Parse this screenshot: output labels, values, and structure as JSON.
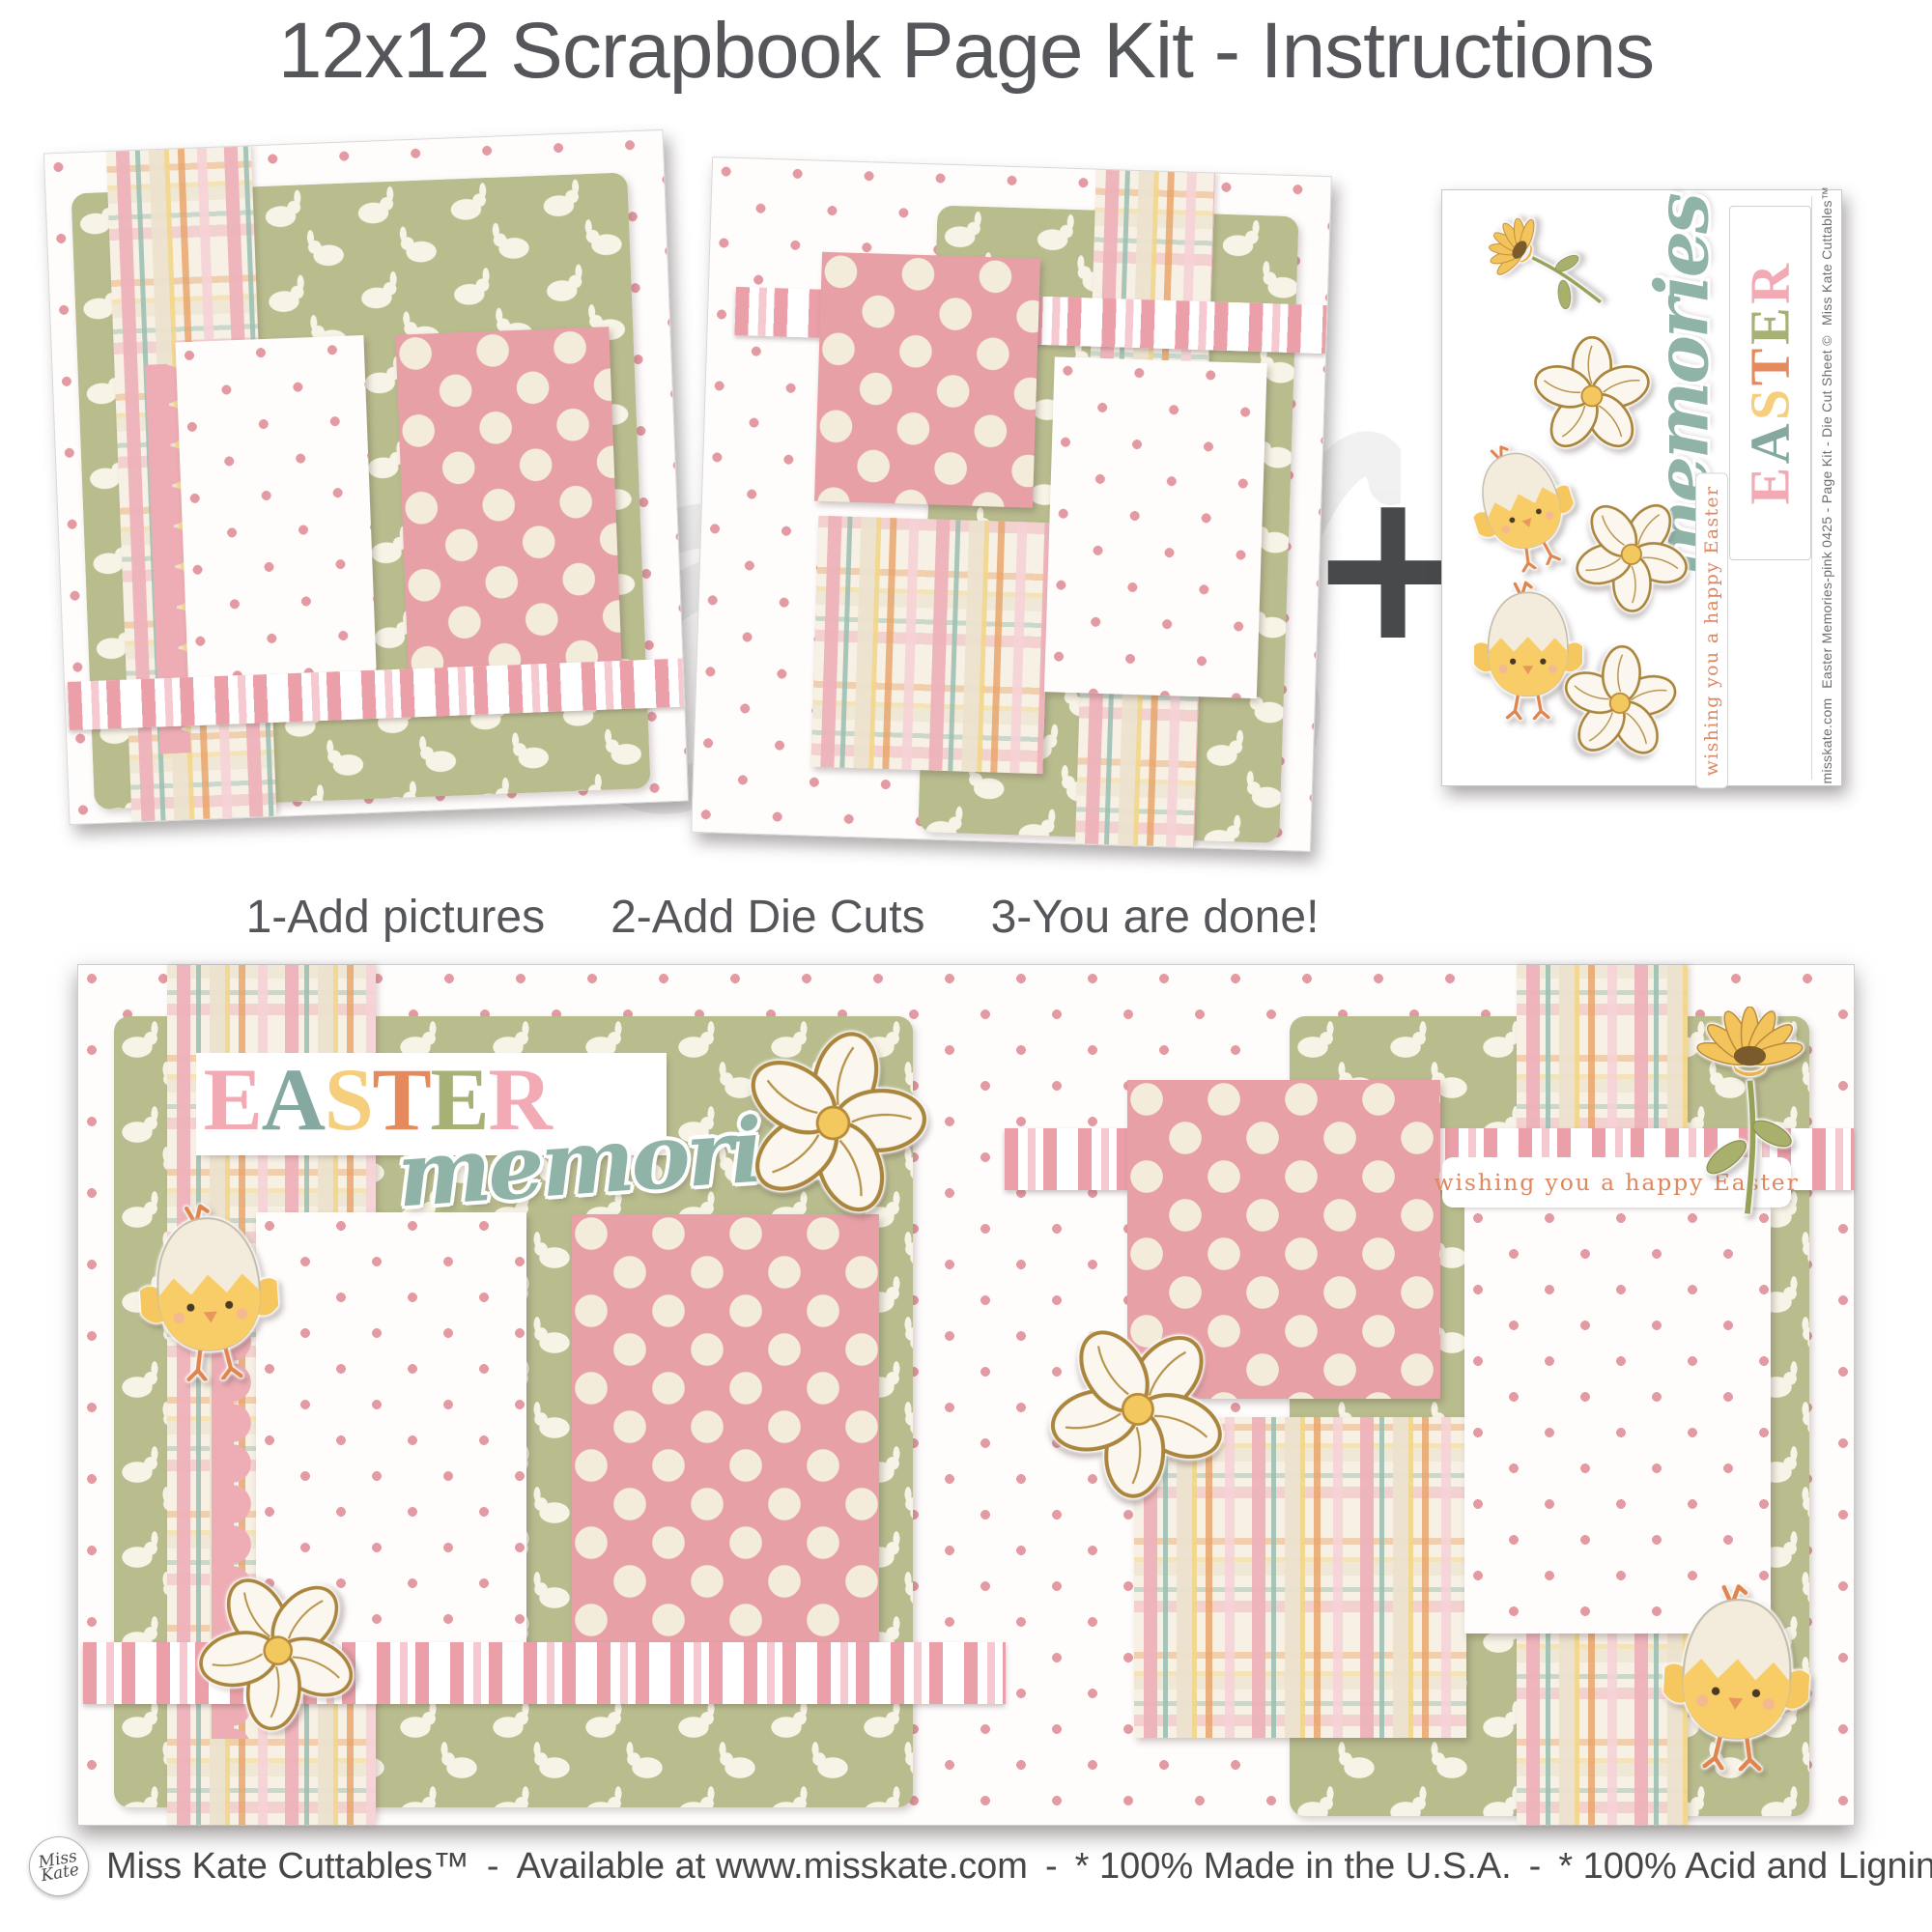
{
  "title": "12x12 Scrapbook Page Kit - Instructions",
  "plus_symbol": "+",
  "steps": {
    "step1": "1-Add pictures",
    "step2": "2-Add Die Cuts",
    "step3": "3-You are done!"
  },
  "easter": {
    "l0": "E",
    "l1": "A",
    "l2": "S",
    "l3": "T",
    "l4": "E",
    "l5": "R"
  },
  "memories_script": "memories",
  "tag_text": "wishing you a happy Easter",
  "die_cut_sheet": {
    "side_line1": "Easter Memories-pink   0425   -   Page Kit - Die Cut Sheet ©",
    "side_line2": "Miss Kate Cuttables™",
    "side_line3": "misskate.com"
  },
  "footer": {
    "logo_line1": "Miss",
    "logo_line2": "Kate",
    "separator": "-",
    "parts": [
      "Miss Kate Cuttables™",
      "Available at www.misskate.com",
      "* 100% Made in the U.S.A.",
      "* 100% Acid and Lignin-Free"
    ]
  },
  "palette": {
    "title_gray": "#54565a",
    "background_dot_pink": "#e49aa2",
    "polka_paper_pink": "#e8a0a7",
    "polka_dot_cream": "#f3ecdb",
    "bunny_paper_green": "#b9bd8e",
    "plaid_cream": "#f6f0e5",
    "ribbon_pink": "#eb9fa8",
    "scallop_pink": "#eeadb5",
    "memories_teal": "#8fb3a7",
    "tag_text_orange": "#e0875f",
    "easter_letter_colors": [
      "#f2abb4",
      "#85a9a1",
      "#f6cf7e",
      "#e58a5c",
      "#a7b175",
      "#f2abb4"
    ]
  }
}
